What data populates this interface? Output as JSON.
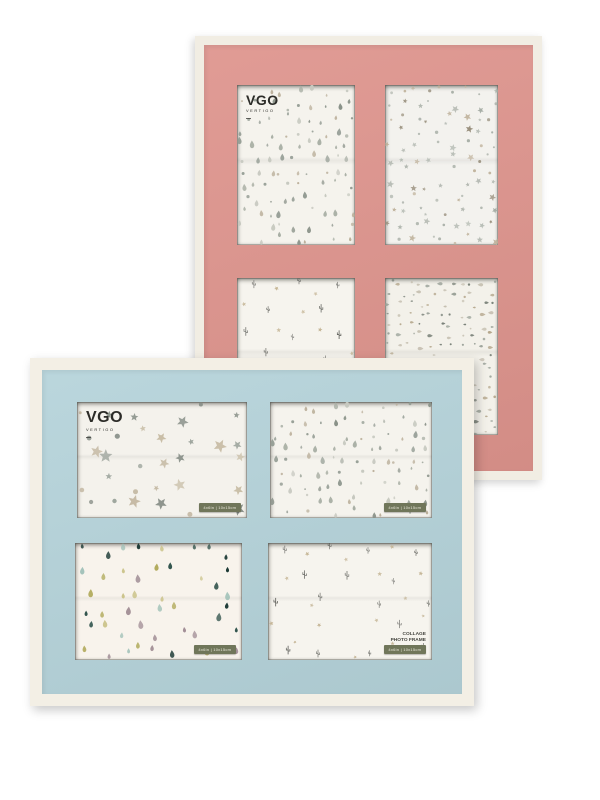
{
  "brand": {
    "logo": "VGO",
    "sub": "VERTIGO",
    "color": "#2c2c28"
  },
  "badge": {
    "text": "4x6in | 10x15cm",
    "bg": "#70765a",
    "fg": "#e9e8da"
  },
  "collage_label": {
    "line1": "COLLAGE",
    "line2": "PHOTO FRAME"
  },
  "frames": [
    {
      "name": "pink collage frame",
      "mat_color": "#de948d",
      "border_color": "#f1ede3",
      "openings": [
        "drops_gray",
        "stars_small",
        "cactus_stars",
        "drops_h"
      ]
    },
    {
      "name": "blue collage frame",
      "mat_color": "#b5d3da",
      "border_color": "#f3efe5",
      "openings": [
        "stars_big",
        "drops_gray",
        "drops_colored",
        "cactus_stars"
      ]
    }
  ],
  "patterns": {
    "drops_gray": {
      "bg": "#f5f3ed",
      "shapes": [
        "drop",
        "drop",
        "dot"
      ],
      "colors": [
        "#a9afa5",
        "#b9ad98",
        "#949c94",
        "#c6c8bf",
        "#8a9289"
      ],
      "cell": 13,
      "min": 3,
      "max": 8,
      "skip": 0.12,
      "seed": 7
    },
    "stars_small": {
      "bg": "#f3f2ee",
      "shapes": [
        "star",
        "star",
        "star",
        "dot",
        "dot"
      ],
      "colors": [
        "#a7aea6",
        "#bfb29b",
        "#b2b8b0",
        "#988f7c"
      ],
      "cell": 13,
      "min": 3.5,
      "max": 8,
      "skip": 0.15,
      "seed": 11
    },
    "stars_big": {
      "bg": "#f4f2ec",
      "shapes": [
        "star",
        "star",
        "star",
        "dot"
      ],
      "colors": [
        "#9aa29a",
        "#bdb098",
        "#868e86",
        "#c8bda6"
      ],
      "cell": 24,
      "min": 6,
      "max": 14,
      "skip": 0.1,
      "seed": 3
    },
    "cactus_stars": {
      "bg": "#f6f4ee",
      "shapes": [
        "cactus",
        "star"
      ],
      "colors": [
        "#4f504b",
        "#c2b291"
      ],
      "cell": 23,
      "min": 6,
      "max": 9,
      "skip": 0.12,
      "seed": 5,
      "checker": true
    },
    "drops_h": {
      "bg": "#f3f1ea",
      "shapes": [
        "hdrop",
        "hdrop",
        "dot"
      ],
      "colors": [
        "#99a097",
        "#b4a68b",
        "#798178",
        "#c6c0b1"
      ],
      "cell": 10.5,
      "min": 2.5,
      "max": 6,
      "skip": 0.12,
      "seed": 9
    },
    "drops_colored": {
      "bg": "#f8f3ec",
      "shapes": [
        "drop"
      ],
      "colors": [
        "#1d3a36",
        "#b1aa5c",
        "#a18d95",
        "#9dbfb6",
        "#ccc48c",
        "#2c4f48"
      ],
      "cell": 19,
      "min": 5,
      "max": 9,
      "skip": 0.15,
      "seed": 13
    }
  }
}
